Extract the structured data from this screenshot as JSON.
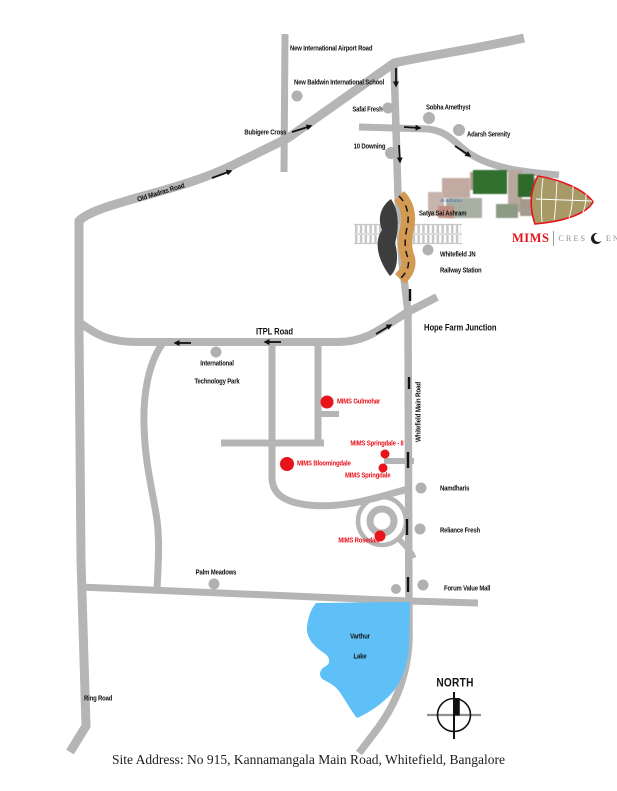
{
  "colors": {
    "road_gray": "#b5b5b5",
    "mims_red": "#e8131b",
    "lake_blue": "#5fc0f7",
    "bridge_tan": "#d29a52"
  },
  "labels": {
    "airport_road": "New International Airport Road",
    "baldwin_school": "New Baldwin International School",
    "bubigere_cross": "Bubigere Cross",
    "safal_fresh": "Safal Fresh",
    "sobha_amethyst": "Sobha Amethyst",
    "ten_downing": "10 Downing",
    "adarsh_serenity": "Adarsh Serenity",
    "old_madras_road": "Old Madras Road",
    "satya_sai_ashram": "Satya Sai Ashram",
    "whitefield_jn_line1": "Whitefield JN",
    "whitefield_jn_line2": "Railway Station",
    "itpl_road": "ITPL Road",
    "hope_farm_junction": "Hope Farm Junction",
    "intl_tech_park_line1": "International",
    "intl_tech_park_line2": "Technology Park",
    "whitefield_main_road": "Whitefield Main Road",
    "mims_gulmohar": "MIMS Gulmohar",
    "mims_springdale_2": "MIMS Springdale - II",
    "mims_bloomingdale": "MIMS Bloomingdale",
    "mims_springdale": "MIMS Springdale",
    "mims_rosedale": "MIMS Rosedale",
    "namdharis": "Namdharis",
    "reliance_fresh": "Reliance Fresh",
    "palm_meadows": "Palm Meadows",
    "forum_value_mall": "Forum Value Mall",
    "varthur_line1": "Varthur",
    "varthur_line2": "Lake",
    "ring_road": "Ring Road",
    "north": "NORTH"
  },
  "photo": {
    "watermark": "Aradhana"
  },
  "logo": {
    "brand": "MIMS",
    "project_pre": "CRES",
    "project_post": "ENTA"
  },
  "footer": {
    "site_address": "Site Address: No 915, Kannamangala Main Road, Whitefield, Bangalore"
  }
}
